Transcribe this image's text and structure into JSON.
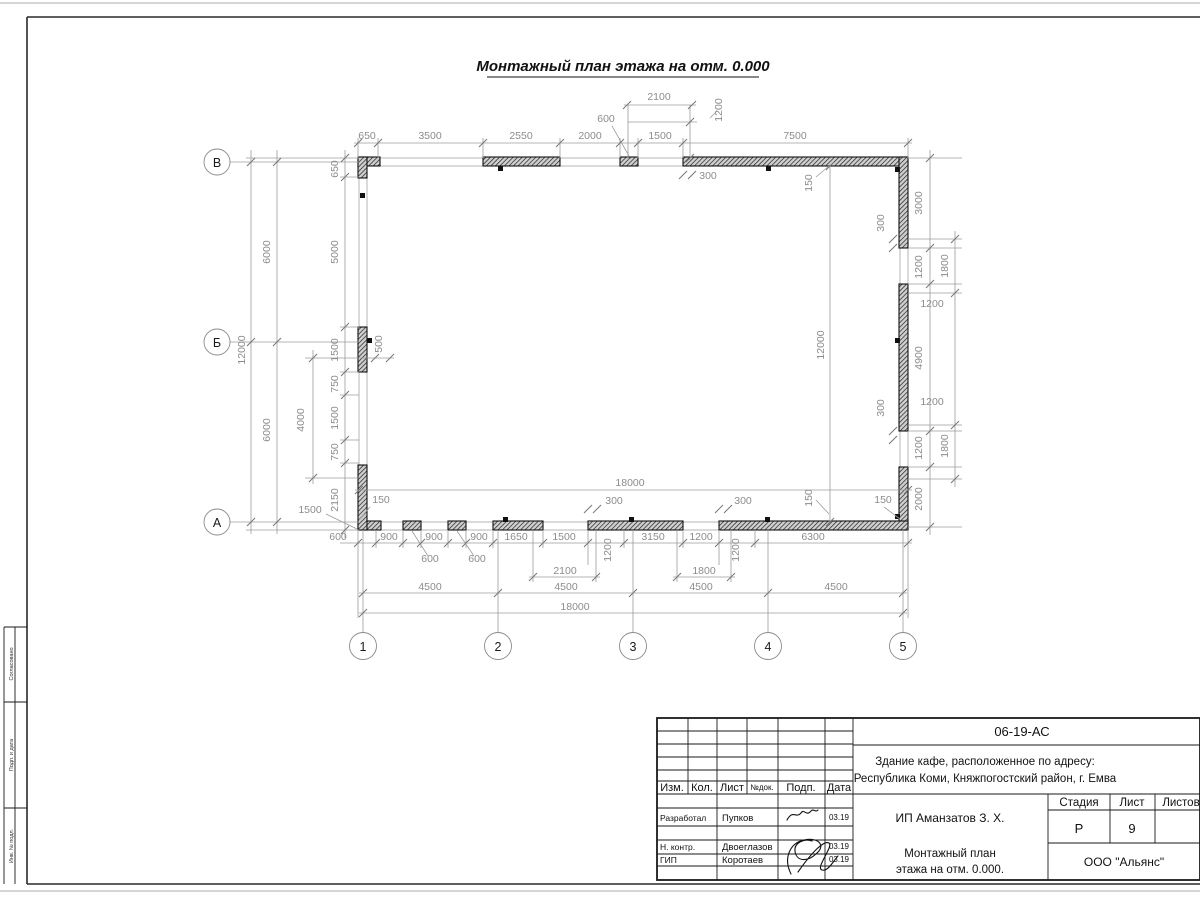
{
  "colors": {
    "dim": "#8c8c8c",
    "line": "#9c9c9c"
  },
  "sheet_title": "Монтажный план этажа на отм. 0.000",
  "axes": {
    "rows": [
      "В",
      "Б",
      "А"
    ],
    "cols": [
      "1",
      "2",
      "3",
      "4",
      "5"
    ]
  },
  "left_strip": {
    "cells": [
      "Согласовано",
      "Подп. и дата",
      "Инв. № подл."
    ]
  },
  "plan": {
    "dimensions": [
      {
        "t": "650",
        "x": 367,
        "y": 139
      },
      {
        "t": "3500",
        "x": 430,
        "y": 139
      },
      {
        "t": "2550",
        "x": 521,
        "y": 139
      },
      {
        "t": "2000",
        "x": 590,
        "y": 139
      },
      {
        "t": "1500",
        "x": 660,
        "y": 139
      },
      {
        "t": "7500",
        "x": 795,
        "y": 139
      },
      {
        "t": "2100",
        "x": 659,
        "y": 100
      },
      {
        "t": "600",
        "x": 606,
        "y": 122
      },
      {
        "t": "1200",
        "x": 722,
        "y": 110,
        "r": 1
      },
      {
        "t": "300",
        "x": 708,
        "y": 179
      },
      {
        "t": "150",
        "x": 812,
        "y": 183,
        "r": 1
      },
      {
        "t": "12000",
        "x": 245,
        "y": 350,
        "r": 1
      },
      {
        "t": "6000",
        "x": 270,
        "y": 252,
        "r": 1
      },
      {
        "t": "6000",
        "x": 270,
        "y": 430,
        "r": 1
      },
      {
        "t": "650",
        "x": 338,
        "y": 169,
        "r": 1
      },
      {
        "t": "5000",
        "x": 338,
        "y": 252,
        "r": 1
      },
      {
        "t": "1500",
        "x": 338,
        "y": 350,
        "r": 1
      },
      {
        "t": "750",
        "x": 338,
        "y": 384,
        "r": 1
      },
      {
        "t": "1500",
        "x": 338,
        "y": 418,
        "r": 1
      },
      {
        "t": "750",
        "x": 338,
        "y": 452,
        "r": 1
      },
      {
        "t": "2150",
        "x": 338,
        "y": 500,
        "r": 1
      },
      {
        "t": "500",
        "x": 382,
        "y": 344,
        "r": 1
      },
      {
        "t": "4000",
        "x": 304,
        "y": 420,
        "r": 1
      },
      {
        "t": "1500",
        "x": 310,
        "y": 513
      },
      {
        "t": "150",
        "x": 381,
        "y": 503
      },
      {
        "t": "12000",
        "x": 824,
        "y": 345,
        "r": 1
      },
      {
        "t": "150",
        "x": 812,
        "y": 498,
        "r": 1
      },
      {
        "t": "3000",
        "x": 922,
        "y": 203,
        "r": 1
      },
      {
        "t": "300",
        "x": 884,
        "y": 223,
        "r": 1
      },
      {
        "t": "1200",
        "x": 922,
        "y": 267,
        "r": 1
      },
      {
        "t": "1800",
        "x": 948,
        "y": 266,
        "r": 1
      },
      {
        "t": "1200",
        "x": 932,
        "y": 307
      },
      {
        "t": "4900",
        "x": 922,
        "y": 358,
        "r": 1
      },
      {
        "t": "1200",
        "x": 932,
        "y": 405
      },
      {
        "t": "300",
        "x": 884,
        "y": 408,
        "r": 1
      },
      {
        "t": "1200",
        "x": 922,
        "y": 448,
        "r": 1
      },
      {
        "t": "1800",
        "x": 948,
        "y": 446,
        "r": 1
      },
      {
        "t": "2000",
        "x": 922,
        "y": 499,
        "r": 1
      },
      {
        "t": "150",
        "x": 883,
        "y": 503
      },
      {
        "t": "18000",
        "x": 630,
        "y": 486
      },
      {
        "t": "600",
        "x": 338,
        "y": 540
      },
      {
        "t": "900",
        "x": 389,
        "y": 540
      },
      {
        "t": "900",
        "x": 434,
        "y": 540
      },
      {
        "t": "900",
        "x": 479,
        "y": 540
      },
      {
        "t": "1650",
        "x": 516,
        "y": 540
      },
      {
        "t": "1500",
        "x": 564,
        "y": 540
      },
      {
        "t": "1200",
        "x": 611,
        "y": 550,
        "r": 1
      },
      {
        "t": "3150",
        "x": 653,
        "y": 540
      },
      {
        "t": "1200",
        "x": 701,
        "y": 540
      },
      {
        "t": "1200",
        "x": 739,
        "y": 550,
        "r": 1
      },
      {
        "t": "6300",
        "x": 813,
        "y": 540
      },
      {
        "t": "300",
        "x": 614,
        "y": 504
      },
      {
        "t": "300",
        "x": 743,
        "y": 504
      },
      {
        "t": "600",
        "x": 430,
        "y": 562
      },
      {
        "t": "600",
        "x": 477,
        "y": 562
      },
      {
        "t": "2100",
        "x": 565,
        "y": 574
      },
      {
        "t": "1800",
        "x": 704,
        "y": 574
      },
      {
        "t": "4500",
        "x": 430,
        "y": 590
      },
      {
        "t": "4500",
        "x": 566,
        "y": 590
      },
      {
        "t": "4500",
        "x": 701,
        "y": 590
      },
      {
        "t": "4500",
        "x": 836,
        "y": 590
      },
      {
        "t": "18000",
        "x": 575,
        "y": 610
      }
    ]
  },
  "title_block": {
    "doc_number": "06-19-АС",
    "object_line1": "Здание кафе, расположенное по адресу:",
    "object_line2": "Республика Коми, Княжпогостский район, г. Емва",
    "client": "ИП Аманзатов З. Х.",
    "drawing_title_line1": "Монтажный план",
    "drawing_title_line2": "этажа на отм. 0.000.",
    "company": "ООО \"Альянс\"",
    "stage_label": "Стадия",
    "sheet_label": "Лист",
    "sheets_label": "Листов",
    "stage_value": "Р",
    "sheet_value": "9",
    "cols": {
      "izm": "Изм.",
      "kol": "Кол.",
      "list": "Лист",
      "ndoc": "№док.",
      "podp": "Подп.",
      "data": "Дата"
    },
    "rows": [
      {
        "role": "Разработал",
        "name": "Пупков",
        "date": "03.19"
      },
      {
        "role": "Н. контр.",
        "name": "Двоеглазов",
        "date": "03.19"
      },
      {
        "role": "ГИП",
        "name": "Коротаев",
        "date": "03.19"
      }
    ]
  }
}
